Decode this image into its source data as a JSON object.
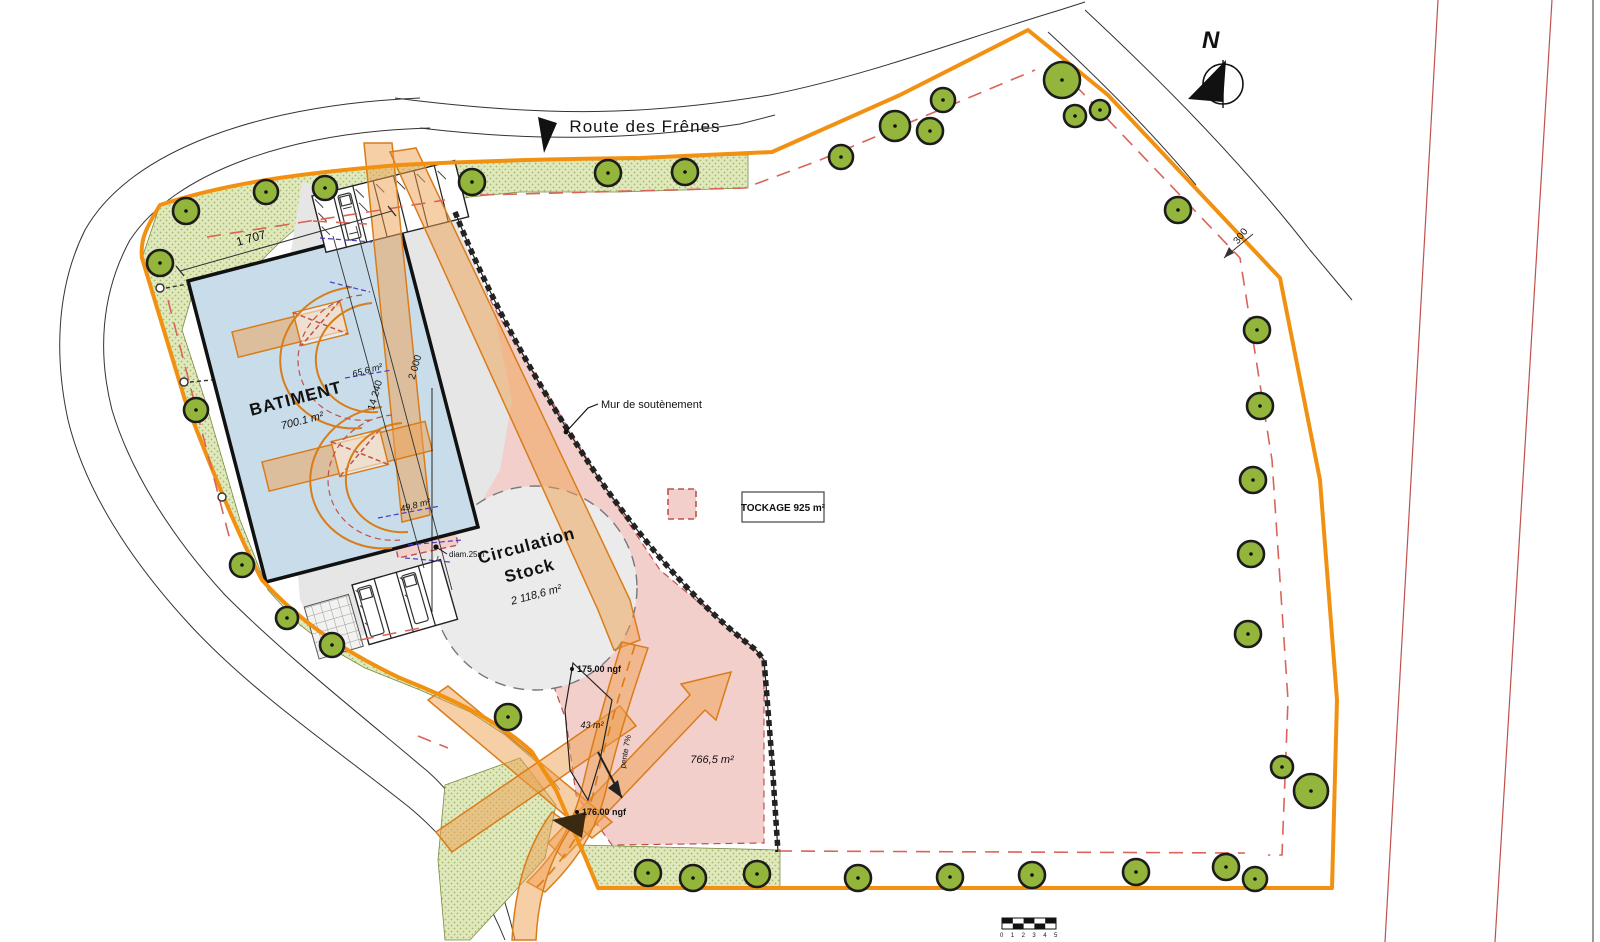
{
  "road": {
    "name": "Route  des Frênes"
  },
  "north": {
    "label": "N"
  },
  "building": {
    "name": "BATIMENT",
    "area": "700.1 m²"
  },
  "circulation": {
    "line1": "Circulation",
    "line2": "Stock",
    "area": "2 118,6 m²"
  },
  "labels": {
    "wall": "Mur de soutènement",
    "diameter": "diam.25m",
    "level_upper": "175.00 ngf",
    "level_lower": "176.00 ngf",
    "slope": "pente 7%"
  },
  "areas": {
    "a43": "43 m²",
    "a766": "766,5 m²",
    "a65": "65,6 m²",
    "a49": "49,8 m²"
  },
  "dimensions": {
    "top": "1 707",
    "d14240": "14 240",
    "d2000": "2 000",
    "d300": "300"
  },
  "legend": {
    "stockage": "TOCKAGE 925 m²"
  },
  "scale_ticks": [
    "0",
    "1",
    "2",
    "3",
    "4",
    "5"
  ],
  "colors": {
    "boundary_orange": "#F29111",
    "band_orange": "#F0A050",
    "green_strip": "#DFE9BC",
    "tree_green": "#94B53C",
    "building_blue": "#C8DDE9",
    "stock_pink": "#F2CFCB",
    "setback_red": "#D96459",
    "apron_gray": "#E6E6E6"
  },
  "trees": [
    {
      "x": 186,
      "y": 211,
      "r": 13
    },
    {
      "x": 266,
      "y": 192,
      "r": 12
    },
    {
      "x": 325,
      "y": 188,
      "r": 12
    },
    {
      "x": 472,
      "y": 182,
      "r": 13
    },
    {
      "x": 608,
      "y": 173,
      "r": 13
    },
    {
      "x": 685,
      "y": 172,
      "r": 13
    },
    {
      "x": 160,
      "y": 263,
      "r": 13
    },
    {
      "x": 196,
      "y": 410,
      "r": 12
    },
    {
      "x": 242,
      "y": 565,
      "r": 12
    },
    {
      "x": 287,
      "y": 618,
      "r": 11
    },
    {
      "x": 332,
      "y": 645,
      "r": 12
    },
    {
      "x": 508,
      "y": 717,
      "r": 13
    },
    {
      "x": 841,
      "y": 157,
      "r": 12
    },
    {
      "x": 895,
      "y": 126,
      "r": 15
    },
    {
      "x": 943,
      "y": 100,
      "r": 12
    },
    {
      "x": 930,
      "y": 131,
      "r": 13
    },
    {
      "x": 1062,
      "y": 80,
      "r": 18
    },
    {
      "x": 1075,
      "y": 116,
      "r": 11
    },
    {
      "x": 1100,
      "y": 110,
      "r": 10
    },
    {
      "x": 1178,
      "y": 210,
      "r": 13
    },
    {
      "x": 1257,
      "y": 330,
      "r": 13
    },
    {
      "x": 1260,
      "y": 406,
      "r": 13
    },
    {
      "x": 1253,
      "y": 480,
      "r": 13
    },
    {
      "x": 1251,
      "y": 554,
      "r": 13
    },
    {
      "x": 1248,
      "y": 634,
      "r": 13
    },
    {
      "x": 1282,
      "y": 767,
      "r": 11
    },
    {
      "x": 1311,
      "y": 791,
      "r": 17
    },
    {
      "x": 1255,
      "y": 879,
      "r": 12
    },
    {
      "x": 648,
      "y": 873,
      "r": 13
    },
    {
      "x": 693,
      "y": 878,
      "r": 13
    },
    {
      "x": 757,
      "y": 874,
      "r": 13
    },
    {
      "x": 858,
      "y": 878,
      "r": 13
    },
    {
      "x": 950,
      "y": 877,
      "r": 13
    },
    {
      "x": 1032,
      "y": 875,
      "r": 13
    },
    {
      "x": 1136,
      "y": 872,
      "r": 13
    },
    {
      "x": 1226,
      "y": 867,
      "r": 13
    }
  ]
}
